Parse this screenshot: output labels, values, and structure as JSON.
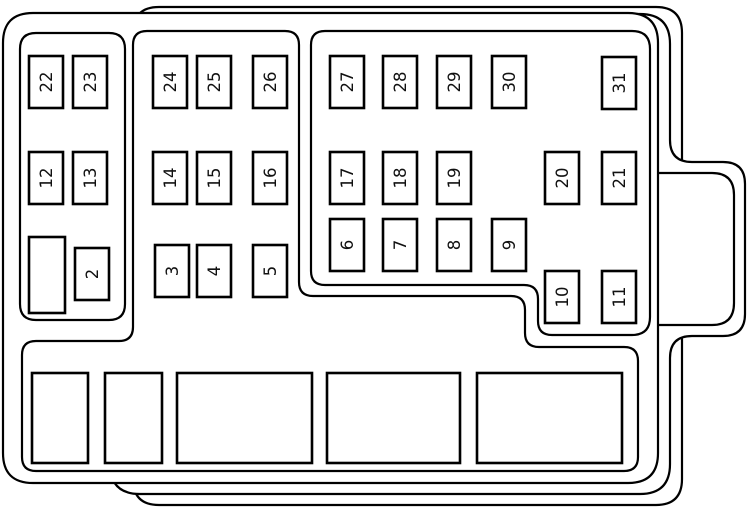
{
  "diagram": {
    "kind": "fuse-box-diagram",
    "background_color": "#ffffff",
    "line_color": "#000000",
    "default_fuse_size": {
      "w": 34,
      "h": 52
    },
    "fuses": [
      {
        "label": "2",
        "x": 75,
        "y": 248
      },
      {
        "label": "3",
        "x": 155,
        "y": 245
      },
      {
        "label": "4",
        "x": 197,
        "y": 245
      },
      {
        "label": "5",
        "x": 253,
        "y": 245
      },
      {
        "label": "6",
        "x": 330,
        "y": 219
      },
      {
        "label": "7",
        "x": 383,
        "y": 219
      },
      {
        "label": "8",
        "x": 437,
        "y": 219
      },
      {
        "label": "9",
        "x": 492,
        "y": 219
      },
      {
        "label": "10",
        "x": 545,
        "y": 271
      },
      {
        "label": "11",
        "x": 602,
        "y": 271
      },
      {
        "label": "12",
        "x": 29,
        "y": 152
      },
      {
        "label": "13",
        "x": 73,
        "y": 152
      },
      {
        "label": "14",
        "x": 153,
        "y": 152
      },
      {
        "label": "15",
        "x": 197,
        "y": 152
      },
      {
        "label": "16",
        "x": 253,
        "y": 152
      },
      {
        "label": "17",
        "x": 330,
        "y": 152
      },
      {
        "label": "18",
        "x": 383,
        "y": 152
      },
      {
        "label": "19",
        "x": 437,
        "y": 152
      },
      {
        "label": "20",
        "x": 545,
        "y": 152
      },
      {
        "label": "21",
        "x": 602,
        "y": 152
      },
      {
        "label": "22",
        "x": 29,
        "y": 56
      },
      {
        "label": "23",
        "x": 73,
        "y": 56
      },
      {
        "label": "24",
        "x": 153,
        "y": 56
      },
      {
        "label": "25",
        "x": 197,
        "y": 56
      },
      {
        "label": "26",
        "x": 253,
        "y": 56
      },
      {
        "label": "27",
        "x": 330,
        "y": 56
      },
      {
        "label": "28",
        "x": 383,
        "y": 56
      },
      {
        "label": "29",
        "x": 437,
        "y": 56
      },
      {
        "label": "30",
        "x": 492,
        "y": 56
      },
      {
        "label": "31",
        "x": 602,
        "y": 57
      }
    ],
    "unlabeled_slots": [
      {
        "x": 29,
        "y": 237,
        "w": 36,
        "h": 76
      }
    ],
    "relay_slots": [
      {
        "x": 32,
        "y": 373,
        "w": 56,
        "h": 90
      },
      {
        "x": 105,
        "y": 373,
        "w": 57,
        "h": 90
      },
      {
        "x": 177,
        "y": 373,
        "w": 135,
        "h": 90
      },
      {
        "x": 327,
        "y": 373,
        "w": 133,
        "h": 90
      },
      {
        "x": 477,
        "y": 373,
        "w": 145,
        "h": 90
      }
    ]
  }
}
